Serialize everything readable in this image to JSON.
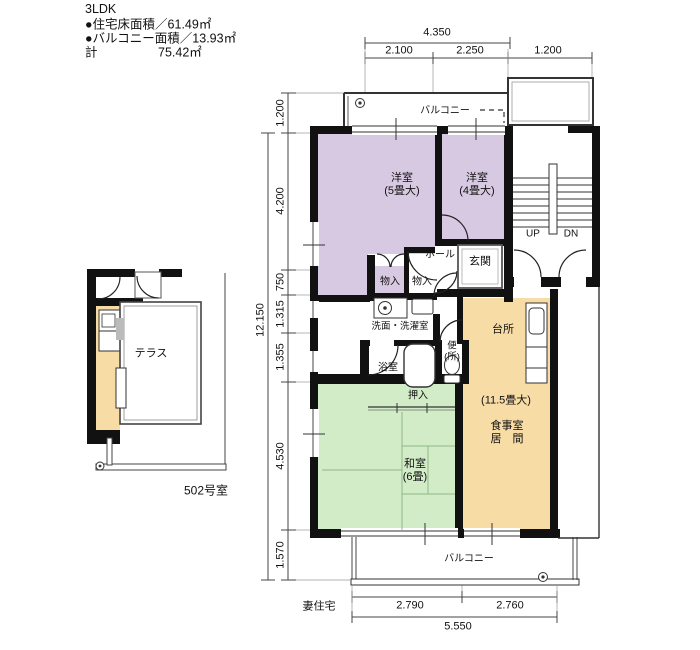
{
  "header": {
    "title": "3LDK",
    "area_line1": "●住宅床面積／61.49㎡",
    "area_line2": "●バルコニー面積／13.93㎡",
    "total_label": "計",
    "total_value": "75.42㎡"
  },
  "dims": {
    "top_total": "4.350",
    "top_seg1": "2.100",
    "top_seg2": "2.250",
    "top_seg3": "1.200",
    "left_total": "12.150",
    "left_seg1": "1.200",
    "left_seg2": "4.200",
    "left_seg3": "750",
    "left_seg4": "1.315",
    "left_seg5": "1.355",
    "left_seg6": "4.530",
    "left_seg7": "1.570",
    "bottom_seg1": "2.790",
    "bottom_seg2": "2.760",
    "bottom_total": "5.550"
  },
  "rooms": {
    "balcony_top": "バルコニー",
    "bedroom1_name": "洋室",
    "bedroom1_size": "(5畳大)",
    "bedroom2_name": "洋室",
    "bedroom2_size": "(4畳大)",
    "hall": "ホール",
    "entrance": "玄関",
    "closet_left": "物入",
    "closet_right": "物入",
    "washroom": "洗面・洗濯室",
    "bath": "浴室",
    "toilet_line1": "便",
    "toilet_line2": "(所)",
    "kitchen": "台所",
    "living_size": "(11.5畳大)",
    "living_line1": "食事室",
    "living_line2": "居　間",
    "oshiire": "押入",
    "washitsu_name": "和室",
    "washitsu_size": "(6畳)",
    "balcony_bottom": "バルコニー",
    "stairs_up": "UP",
    "stairs_down": "DN"
  },
  "annex": {
    "terrace": "テラス",
    "unit_label": "502号室"
  },
  "footer": {
    "building_side": "妻住宅"
  },
  "colors": {
    "bedroom_fill": "#d8c9e2",
    "tatami_fill": "#d3ecc8",
    "wood_fill": "#f8dca6",
    "wall": "#111111",
    "dim_line": "#444444"
  }
}
